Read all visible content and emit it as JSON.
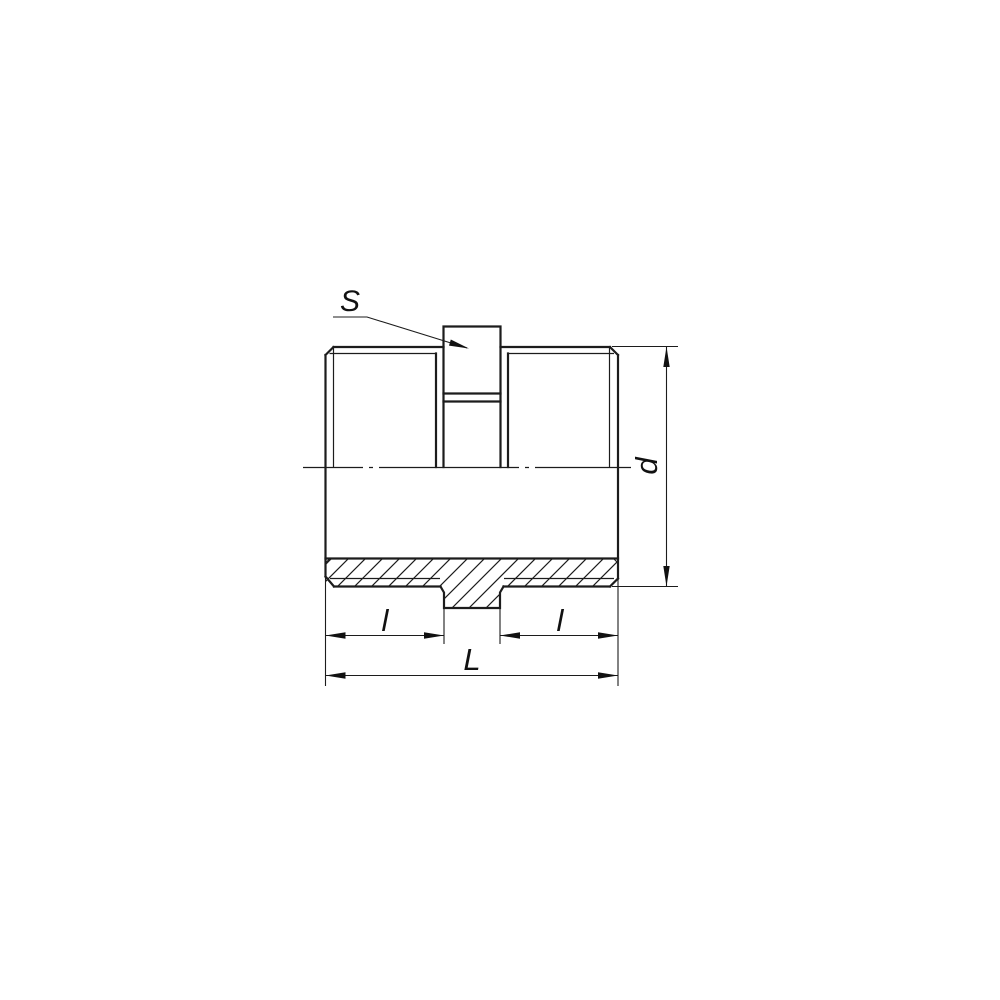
{
  "drawing": {
    "type": "technical-drawing-pipe-nipple",
    "labels": {
      "width_across_flats": "S",
      "diameter": "d",
      "length_left": "l",
      "length_right": "l",
      "overall_length": "L"
    },
    "colors": {
      "line": "#1c1c1c",
      "background": "#ffffff"
    }
  }
}
